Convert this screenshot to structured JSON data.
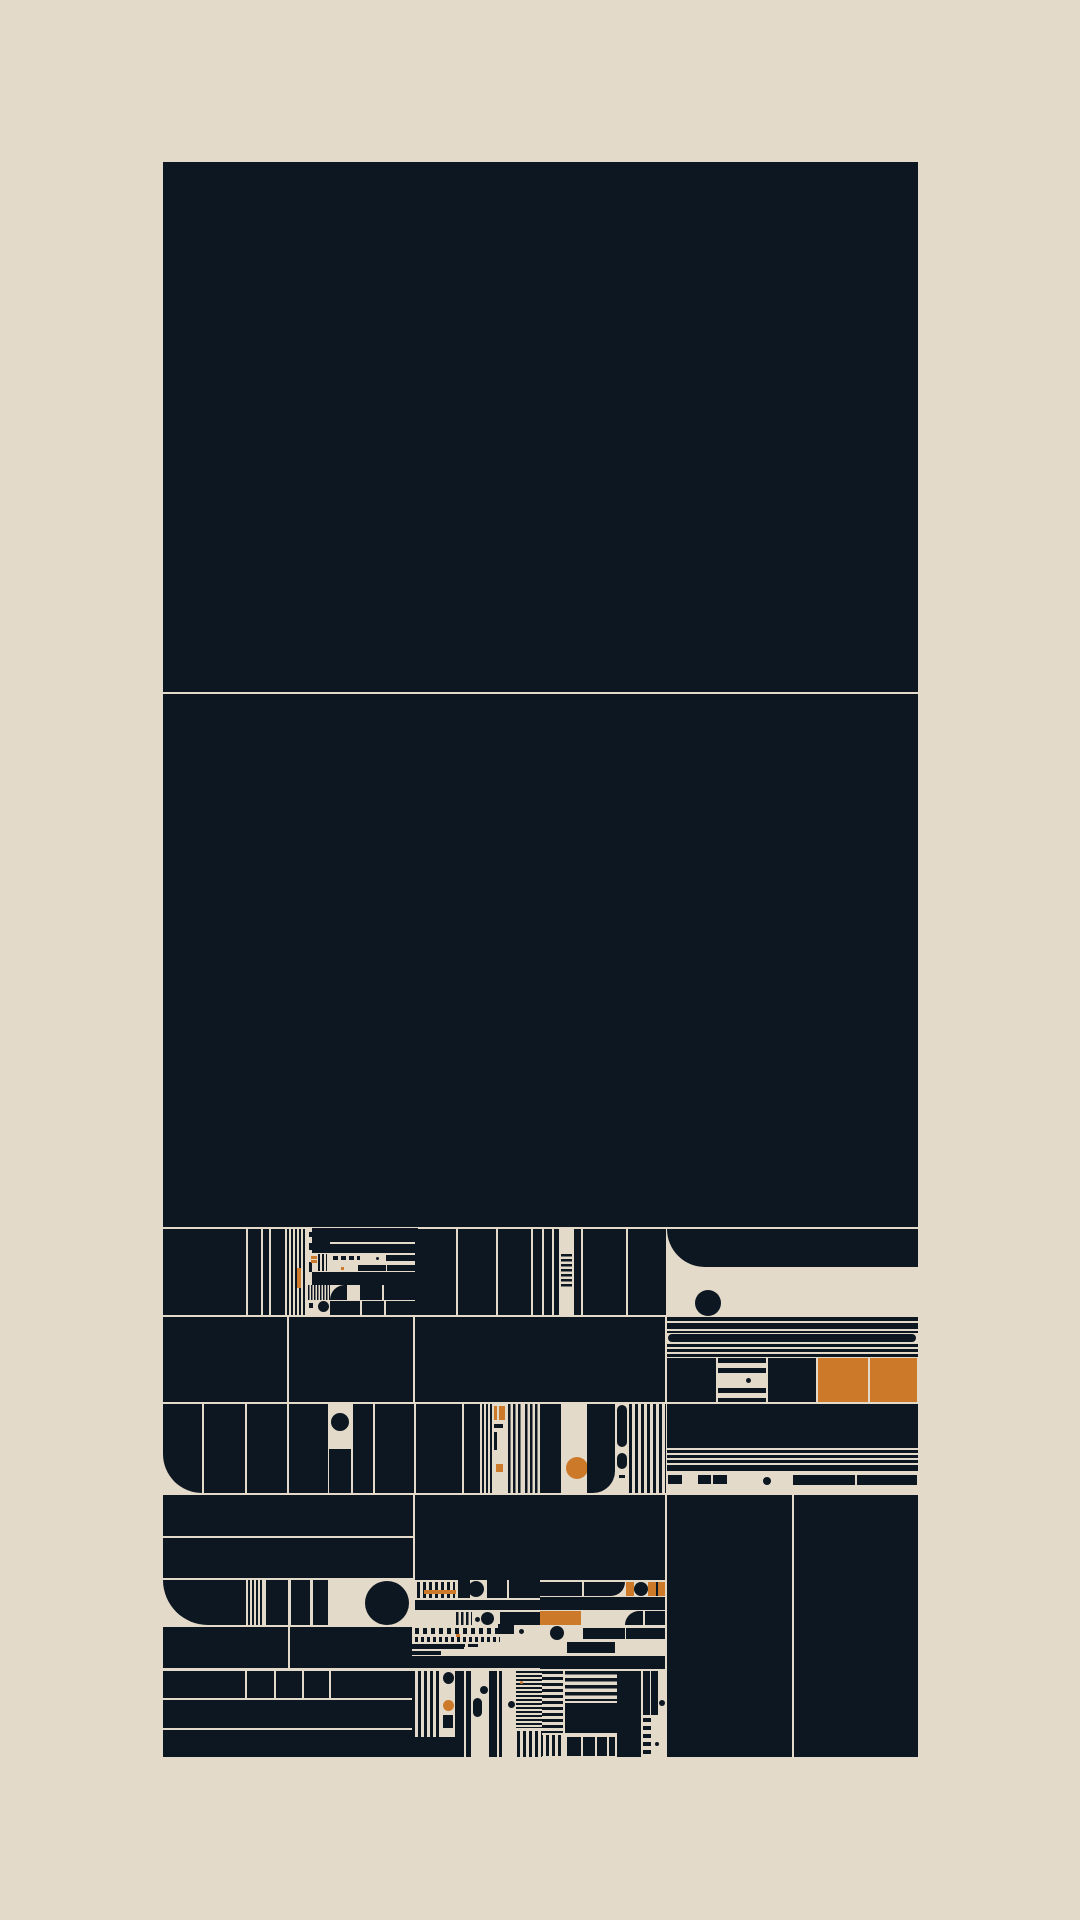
{
  "artwork": {
    "description": "abstract generative grid composition, no text",
    "canvas": {
      "width": 1080,
      "height": 1920
    },
    "panel": {
      "x": 163,
      "y": 162,
      "w": 755,
      "h": 1595
    }
  },
  "palette": {
    "bg": "#e3dac9",
    "ink": "#0d1722",
    "accent": "#cc7a2a"
  },
  "shapes": [
    {
      "n": "big-block-top",
      "x": 163,
      "y": 162,
      "w": 755,
      "h": 530
    },
    {
      "n": "big-block-middle",
      "x": 163,
      "y": 694,
      "w": 755,
      "h": 533
    },
    {
      "x": 163,
      "y": 1229,
      "w": 83,
      "h": 86
    },
    {
      "x": 248,
      "y": 1229,
      "w": 13,
      "h": 86
    },
    {
      "x": 263,
      "y": 1229,
      "w": 6,
      "h": 86
    },
    {
      "x": 271,
      "y": 1229,
      "w": 14,
      "h": 86
    },
    {
      "x": 287,
      "y": 1229,
      "w": 20,
      "h": 86,
      "s": "v",
      "t": 2
    },
    {
      "f": "accent",
      "x": 297,
      "y": 1268,
      "w": 4,
      "h": 20
    },
    {
      "x": 309,
      "y": 1232,
      "w": 5,
      "h": 5
    },
    {
      "x": 309,
      "y": 1243,
      "w": 4,
      "h": 7
    },
    {
      "x": 309,
      "y": 1262,
      "w": 3,
      "h": 10
    },
    {
      "x": 309,
      "y": 1289,
      "w": 4,
      "h": 8
    },
    {
      "x": 309,
      "y": 1303,
      "w": 4,
      "h": 5
    },
    {
      "x": 312,
      "y": 1228,
      "w": 18,
      "h": 25
    },
    {
      "x": 330,
      "y": 1228,
      "w": 88,
      "h": 14
    },
    {
      "x": 330,
      "y": 1244,
      "w": 88,
      "h": 9
    },
    {
      "f": "accent",
      "x": 311,
      "y": 1256,
      "w": 6,
      "h": 3
    },
    {
      "f": "accent",
      "x": 311,
      "y": 1260,
      "w": 6,
      "h": 3
    },
    {
      "x": 318,
      "y": 1254,
      "w": 9,
      "h": 17,
      "s": "v",
      "t": 2
    },
    {
      "x": 333,
      "y": 1256,
      "w": 5,
      "h": 4
    },
    {
      "x": 341,
      "y": 1256,
      "w": 5,
      "h": 4
    },
    {
      "x": 349,
      "y": 1256,
      "w": 5,
      "h": 4
    },
    {
      "x": 357,
      "y": 1256,
      "w": 3,
      "h": 4
    },
    {
      "x": 376,
      "y": 1257,
      "w": 3,
      "h": 3,
      "r": "50%"
    },
    {
      "x": 386,
      "y": 1255,
      "w": 32,
      "h": 6
    },
    {
      "f": "accent",
      "x": 341,
      "y": 1267,
      "w": 3,
      "h": 3
    },
    {
      "x": 358,
      "y": 1265,
      "w": 28,
      "h": 6
    },
    {
      "x": 387,
      "y": 1265,
      "w": 31,
      "h": 6
    },
    {
      "x": 312,
      "y": 1272,
      "w": 106,
      "h": 13
    },
    {
      "x": 308,
      "y": 1285,
      "w": 22,
      "h": 15,
      "s": "v",
      "t": 1.5
    },
    {
      "n": "quarter-round-block",
      "x": 330,
      "y": 1285,
      "w": 17,
      "h": 15,
      "r": "17px 0 0 0"
    },
    {
      "x": 360,
      "y": 1285,
      "w": 22,
      "h": 15
    },
    {
      "x": 384,
      "y": 1285,
      "w": 34,
      "h": 15
    },
    {
      "n": "circle-dot",
      "x": 318,
      "y": 1301,
      "w": 11,
      "h": 11,
      "r": "50%"
    },
    {
      "x": 330,
      "y": 1301,
      "w": 30,
      "h": 14
    },
    {
      "x": 362,
      "y": 1301,
      "w": 22,
      "h": 14
    },
    {
      "x": 386,
      "y": 1301,
      "w": 32,
      "h": 14
    },
    {
      "x": 415,
      "y": 1229,
      "w": 41,
      "h": 86
    },
    {
      "x": 458,
      "y": 1229,
      "w": 38,
      "h": 86
    },
    {
      "x": 498,
      "y": 1229,
      "w": 33,
      "h": 86
    },
    {
      "x": 533,
      "y": 1229,
      "w": 9,
      "h": 86
    },
    {
      "x": 544,
      "y": 1229,
      "w": 8,
      "h": 86
    },
    {
      "x": 554,
      "y": 1229,
      "w": 5,
      "h": 86
    },
    {
      "n": "ladder-column",
      "x": 561,
      "y": 1254,
      "w": 11,
      "h": 33,
      "s": "h",
      "t": 2.5
    },
    {
      "x": 574,
      "y": 1229,
      "w": 7,
      "h": 86
    },
    {
      "x": 583,
      "y": 1229,
      "w": 43,
      "h": 86
    },
    {
      "x": 628,
      "y": 1229,
      "w": 38,
      "h": 86
    },
    {
      "n": "rounded-corner-block",
      "x": 667,
      "y": 1229,
      "w": 251,
      "h": 38,
      "r": "0 0 0 38px"
    },
    {
      "n": "ink-circle",
      "x": 695,
      "y": 1290,
      "w": 26,
      "h": 26,
      "r": "50%"
    },
    {
      "x": 163,
      "y": 1317,
      "w": 124,
      "h": 85
    },
    {
      "x": 289,
      "y": 1317,
      "w": 124,
      "h": 85
    },
    {
      "x": 415,
      "y": 1317,
      "w": 250,
      "h": 85
    },
    {
      "x": 667,
      "y": 1317,
      "w": 251,
      "h": 4
    },
    {
      "x": 667,
      "y": 1323,
      "w": 251,
      "h": 6
    },
    {
      "x": 667,
      "y": 1331,
      "w": 251,
      "h": 2
    },
    {
      "n": "pill",
      "x": 668,
      "y": 1334,
      "w": 248,
      "h": 8,
      "r": "4px"
    },
    {
      "x": 667,
      "y": 1344,
      "w": 251,
      "h": 3
    },
    {
      "x": 667,
      "y": 1349,
      "w": 251,
      "h": 3
    },
    {
      "x": 667,
      "y": 1354,
      "w": 251,
      "h": 3
    },
    {
      "x": 667,
      "y": 1358,
      "w": 49,
      "h": 44
    },
    {
      "x": 718,
      "y": 1358,
      "w": 48,
      "h": 44,
      "s": "h",
      "t": 5
    },
    {
      "f": "bg",
      "x": 718,
      "y": 1374,
      "w": 48,
      "h": 12
    },
    {
      "x": 746,
      "y": 1378,
      "w": 5,
      "h": 5,
      "r": "50%"
    },
    {
      "x": 768,
      "y": 1358,
      "w": 48,
      "h": 44
    },
    {
      "n": "accent-cell",
      "f": "accent",
      "x": 818,
      "y": 1358,
      "w": 50,
      "h": 44
    },
    {
      "n": "accent-cell",
      "f": "accent",
      "x": 870,
      "y": 1358,
      "w": 47,
      "h": 44
    },
    {
      "n": "rounded-corner-block",
      "x": 163,
      "y": 1404,
      "w": 39,
      "h": 89,
      "r": "0 0 0 40px"
    },
    {
      "x": 204,
      "y": 1404,
      "w": 41,
      "h": 89
    },
    {
      "x": 247,
      "y": 1404,
      "w": 40,
      "h": 89
    },
    {
      "x": 289,
      "y": 1404,
      "w": 39,
      "h": 89
    },
    {
      "n": "ink-circle",
      "x": 331,
      "y": 1413,
      "w": 18,
      "h": 18,
      "r": "50%"
    },
    {
      "x": 329,
      "y": 1449,
      "w": 22,
      "h": 44
    },
    {
      "x": 353,
      "y": 1404,
      "w": 20,
      "h": 89
    },
    {
      "x": 375,
      "y": 1404,
      "w": 39,
      "h": 89
    },
    {
      "x": 416,
      "y": 1404,
      "w": 46,
      "h": 89
    },
    {
      "x": 464,
      "y": 1404,
      "w": 16,
      "h": 89
    },
    {
      "x": 482,
      "y": 1404,
      "w": 10,
      "h": 89,
      "s": "v",
      "t": 2
    },
    {
      "f": "accent",
      "x": 494,
      "y": 1406,
      "w": 3,
      "h": 14
    },
    {
      "f": "accent",
      "x": 499,
      "y": 1406,
      "w": 6,
      "h": 14
    },
    {
      "x": 494,
      "y": 1424,
      "w": 9,
      "h": 4
    },
    {
      "x": 494,
      "y": 1432,
      "w": 3,
      "h": 18
    },
    {
      "x": 508,
      "y": 1404,
      "w": 13,
      "h": 89,
      "s": "v",
      "t": 2.5
    },
    {
      "f": "accent",
      "x": 496,
      "y": 1464,
      "w": 7,
      "h": 8
    },
    {
      "x": 525,
      "y": 1404,
      "w": 15,
      "h": 89,
      "s": "v",
      "t": 2.5
    },
    {
      "x": 540,
      "y": 1404,
      "w": 21,
      "h": 89
    },
    {
      "n": "accent-circle",
      "f": "accent",
      "x": 566,
      "y": 1457,
      "w": 22,
      "h": 22,
      "r": "50%"
    },
    {
      "n": "rounded-corner-block",
      "x": 587,
      "y": 1404,
      "w": 28,
      "h": 89,
      "r": "0 0 22px 0"
    },
    {
      "n": "pill",
      "x": 617,
      "y": 1405,
      "w": 10,
      "h": 42,
      "r": "5px"
    },
    {
      "n": "pill",
      "x": 617,
      "y": 1453,
      "w": 10,
      "h": 16,
      "r": "5px"
    },
    {
      "x": 619,
      "y": 1475,
      "w": 6,
      "h": 3
    },
    {
      "x": 629,
      "y": 1404,
      "w": 37,
      "h": 89,
      "s": "v",
      "t": 3
    },
    {
      "x": 667,
      "y": 1404,
      "w": 251,
      "h": 44
    },
    {
      "x": 667,
      "y": 1450,
      "w": 251,
      "h": 3
    },
    {
      "x": 667,
      "y": 1455,
      "w": 251,
      "h": 3
    },
    {
      "x": 667,
      "y": 1460,
      "w": 251,
      "h": 3
    },
    {
      "x": 667,
      "y": 1465,
      "w": 251,
      "h": 6
    },
    {
      "x": 668,
      "y": 1475,
      "w": 14,
      "h": 9
    },
    {
      "x": 698,
      "y": 1475,
      "w": 13,
      "h": 9
    },
    {
      "x": 713,
      "y": 1475,
      "w": 14,
      "h": 9
    },
    {
      "x": 763,
      "y": 1477,
      "w": 8,
      "h": 8,
      "r": "50%"
    },
    {
      "x": 793,
      "y": 1475,
      "w": 62,
      "h": 10
    },
    {
      "x": 857,
      "y": 1475,
      "w": 60,
      "h": 10
    },
    {
      "x": 163,
      "y": 1495,
      "w": 250,
      "h": 41
    },
    {
      "x": 163,
      "y": 1538,
      "w": 250,
      "h": 40
    },
    {
      "x": 415,
      "y": 1495,
      "w": 250,
      "h": 85
    },
    {
      "n": "big-column-left",
      "x": 667,
      "y": 1495,
      "w": 125,
      "h": 262
    },
    {
      "n": "big-column-right",
      "x": 794,
      "y": 1495,
      "w": 124,
      "h": 262
    },
    {
      "n": "rounded-corner-block",
      "x": 163,
      "y": 1580,
      "w": 83,
      "h": 45,
      "r": "0 0 0 45px"
    },
    {
      "x": 248,
      "y": 1580,
      "w": 15,
      "h": 45,
      "s": "v",
      "t": 2
    },
    {
      "x": 266,
      "y": 1580,
      "w": 22,
      "h": 45
    },
    {
      "x": 291,
      "y": 1580,
      "w": 19,
      "h": 45
    },
    {
      "x": 313,
      "y": 1580,
      "w": 15,
      "h": 45
    },
    {
      "n": "big-circle",
      "x": 365,
      "y": 1581,
      "w": 44,
      "h": 44,
      "r": "50%"
    },
    {
      "x": 417,
      "y": 1582,
      "w": 38,
      "h": 16,
      "s": "v",
      "t": 3
    },
    {
      "f": "accent",
      "x": 424,
      "y": 1590,
      "w": 32,
      "h": 4
    },
    {
      "x": 458,
      "y": 1580,
      "w": 12,
      "h": 18
    },
    {
      "x": 468,
      "y": 1581,
      "w": 16,
      "h": 16,
      "r": "50%"
    },
    {
      "x": 487,
      "y": 1580,
      "w": 20,
      "h": 18
    },
    {
      "x": 509,
      "y": 1580,
      "w": 31,
      "h": 18
    },
    {
      "x": 415,
      "y": 1600,
      "w": 125,
      "h": 10
    },
    {
      "x": 456,
      "y": 1612,
      "w": 16,
      "h": 13,
      "s": "v",
      "t": 2.5
    },
    {
      "x": 475,
      "y": 1617,
      "w": 5,
      "h": 5,
      "r": "50%"
    },
    {
      "x": 481,
      "y": 1612,
      "w": 13,
      "h": 13,
      "r": "50%"
    },
    {
      "x": 500,
      "y": 1612,
      "w": 40,
      "h": 13
    },
    {
      "x": 540,
      "y": 1582,
      "w": 42,
      "h": 14
    },
    {
      "n": "rounded-corner-block",
      "x": 584,
      "y": 1582,
      "w": 41,
      "h": 14,
      "r": "0 0 16px 0"
    },
    {
      "f": "accent",
      "x": 626,
      "y": 1582,
      "w": 8,
      "h": 14
    },
    {
      "x": 634,
      "y": 1582,
      "w": 14,
      "h": 14,
      "r": "50%"
    },
    {
      "f": "accent",
      "x": 648,
      "y": 1582,
      "w": 17,
      "h": 14
    },
    {
      "x": 656,
      "y": 1582,
      "w": 2,
      "h": 14
    },
    {
      "x": 540,
      "y": 1597,
      "w": 125,
      "h": 13
    },
    {
      "n": "accent-cell",
      "f": "accent",
      "x": 540,
      "y": 1611,
      "w": 41,
      "h": 14
    },
    {
      "n": "rounded-corner-block",
      "x": 625,
      "y": 1611,
      "w": 18,
      "h": 14,
      "r": "14px 0 0 0"
    },
    {
      "x": 645,
      "y": 1611,
      "w": 20,
      "h": 14
    },
    {
      "n": "ink-circle",
      "x": 550,
      "y": 1626,
      "w": 14,
      "h": 14,
      "r": "50%"
    },
    {
      "x": 583,
      "y": 1628,
      "w": 42,
      "h": 11
    },
    {
      "x": 626,
      "y": 1628,
      "w": 39,
      "h": 11
    },
    {
      "x": 567,
      "y": 1642,
      "w": 48,
      "h": 11
    },
    {
      "x": 540,
      "y": 1656,
      "w": 125,
      "h": 13
    },
    {
      "x": 540,
      "y": 1671,
      "w": 23,
      "h": 62,
      "s": "h",
      "t": 3
    },
    {
      "x": 565,
      "y": 1671,
      "w": 52,
      "h": 30,
      "s": "h",
      "t": 3.5
    },
    {
      "x": 565,
      "y": 1703,
      "w": 52,
      "h": 30
    },
    {
      "x": 617,
      "y": 1671,
      "w": 24,
      "h": 86
    },
    {
      "x": 643,
      "y": 1671,
      "w": 7,
      "h": 44
    },
    {
      "x": 651,
      "y": 1671,
      "w": 7,
      "h": 44
    },
    {
      "x": 659,
      "y": 1700,
      "w": 6,
      "h": 6,
      "r": "50%"
    },
    {
      "n": "ladder-column",
      "x": 643,
      "y": 1718,
      "w": 8,
      "h": 38,
      "s": "h",
      "t": 4
    },
    {
      "x": 655,
      "y": 1742,
      "w": 4,
      "h": 4,
      "r": "50%"
    },
    {
      "x": 567,
      "y": 1737,
      "w": 14,
      "h": 19
    },
    {
      "x": 583,
      "y": 1737,
      "w": 12,
      "h": 19
    },
    {
      "x": 597,
      "y": 1737,
      "w": 10,
      "h": 19
    },
    {
      "x": 609,
      "y": 1737,
      "w": 6,
      "h": 19
    },
    {
      "x": 540,
      "y": 1735,
      "w": 23,
      "h": 21,
      "s": "v",
      "t": 3
    },
    {
      "x": 163,
      "y": 1627,
      "w": 125,
      "h": 41
    },
    {
      "x": 290,
      "y": 1627,
      "w": 122,
      "h": 41
    },
    {
      "x": 163,
      "y": 1671,
      "w": 82,
      "h": 27
    },
    {
      "x": 247,
      "y": 1671,
      "w": 27,
      "h": 27
    },
    {
      "x": 276,
      "y": 1671,
      "w": 26,
      "h": 27
    },
    {
      "x": 304,
      "y": 1671,
      "w": 25,
      "h": 27
    },
    {
      "x": 331,
      "y": 1671,
      "w": 81,
      "h": 27
    },
    {
      "x": 163,
      "y": 1700,
      "w": 249,
      "h": 28
    },
    {
      "x": 163,
      "y": 1730,
      "w": 249,
      "h": 27
    },
    {
      "x": 415,
      "y": 1628,
      "w": 97,
      "h": 6,
      "s": "v",
      "t": 4
    },
    {
      "f": "accent",
      "x": 456,
      "y": 1634,
      "w": 4,
      "h": 3
    },
    {
      "x": 498,
      "y": 1624,
      "w": 16,
      "h": 10
    },
    {
      "x": 519,
      "y": 1629,
      "w": 5,
      "h": 5,
      "r": "50%"
    },
    {
      "x": 415,
      "y": 1637,
      "w": 85,
      "h": 5,
      "s": "v",
      "t": 3
    },
    {
      "x": 412,
      "y": 1644,
      "w": 52,
      "h": 5
    },
    {
      "x": 412,
      "y": 1651,
      "w": 29,
      "h": 4
    },
    {
      "x": 455,
      "y": 1644,
      "w": 10,
      "h": 3
    },
    {
      "x": 468,
      "y": 1644,
      "w": 10,
      "h": 3
    },
    {
      "x": 412,
      "y": 1656,
      "w": 130,
      "h": 12
    },
    {
      "x": 412,
      "y": 1671,
      "w": 28,
      "h": 86,
      "s": "v",
      "t": 3
    },
    {
      "x": 443,
      "y": 1672,
      "w": 11,
      "h": 12,
      "r": "50%"
    },
    {
      "n": "accent-circle",
      "f": "accent",
      "x": 443,
      "y": 1700,
      "w": 11,
      "h": 11,
      "r": "50%"
    },
    {
      "x": 443,
      "y": 1715,
      "w": 10,
      "h": 13
    },
    {
      "x": 455,
      "y": 1671,
      "w": 9,
      "h": 86
    },
    {
      "x": 466,
      "y": 1671,
      "w": 5,
      "h": 86
    },
    {
      "n": "pill",
      "x": 473,
      "y": 1698,
      "w": 9,
      "h": 19,
      "r": "5px"
    },
    {
      "x": 480,
      "y": 1686,
      "w": 8,
      "h": 8,
      "r": "50%"
    },
    {
      "x": 489,
      "y": 1671,
      "w": 8,
      "h": 86
    },
    {
      "x": 499,
      "y": 1671,
      "w": 3,
      "h": 86
    },
    {
      "x": 508,
      "y": 1701,
      "w": 7,
      "h": 7,
      "r": "50%"
    },
    {
      "x": 516,
      "y": 1671,
      "w": 26,
      "h": 57,
      "s": "h",
      "t": 2
    },
    {
      "n": "accent-dot",
      "f": "accent",
      "x": 520,
      "y": 1681,
      "w": 3,
      "h": 3,
      "r": "50%"
    },
    {
      "x": 517,
      "y": 1731,
      "w": 25,
      "h": 26,
      "s": "v",
      "t": 3
    },
    {
      "x": 412,
      "y": 1737,
      "w": 52,
      "h": 20
    }
  ]
}
